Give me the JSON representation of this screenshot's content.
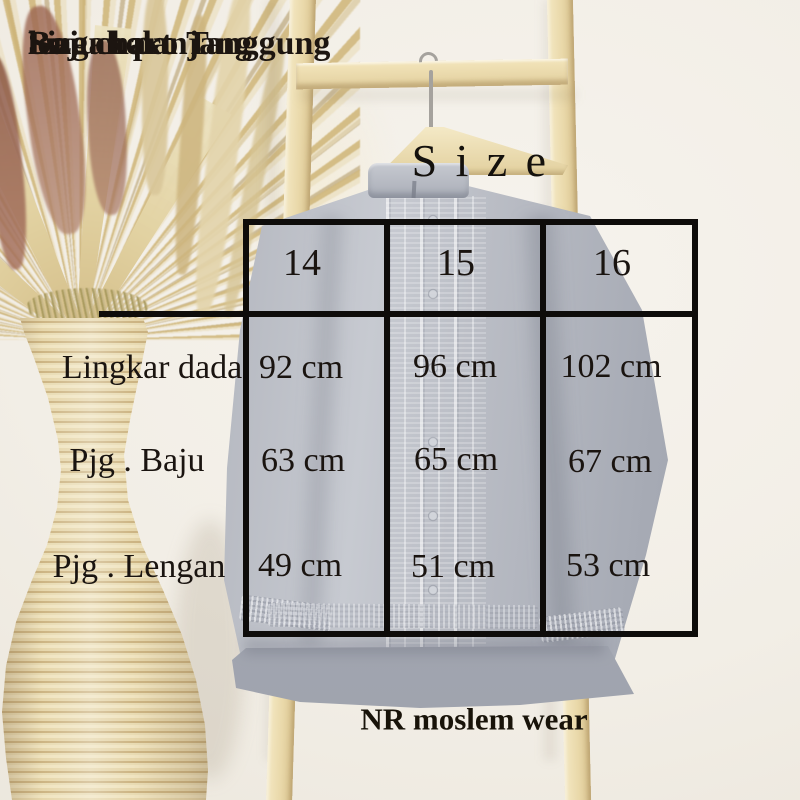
{
  "heading": {
    "line1": "Size chart",
    "line2": "Baju koko Tanggung",
    "line3": "lengan panjang"
  },
  "size_title": "Size",
  "brand": "NR moslem wear",
  "chart_data": {
    "type": "table",
    "title": "Size chart Baju koko Tanggung lengan panjang",
    "units": "cm",
    "columns": [
      "14",
      "15",
      "16"
    ],
    "rows": [
      {
        "label": "Lingkar dada",
        "values": [
          "92 cm",
          "96 cm",
          "102 cm"
        ]
      },
      {
        "label": "Pjg . Baju",
        "values": [
          "63 cm",
          "65 cm",
          "67 cm"
        ]
      },
      {
        "label": "Pjg . Lengan",
        "values": [
          "49 cm",
          "51 cm",
          "53 cm"
        ]
      }
    ]
  },
  "colors": {
    "text": "#1a1410",
    "table_lines": "#0e0c0a",
    "shirt_gray": "#b2b5be",
    "wood": "#eadfb6",
    "vase": "#ebdcb2"
  }
}
